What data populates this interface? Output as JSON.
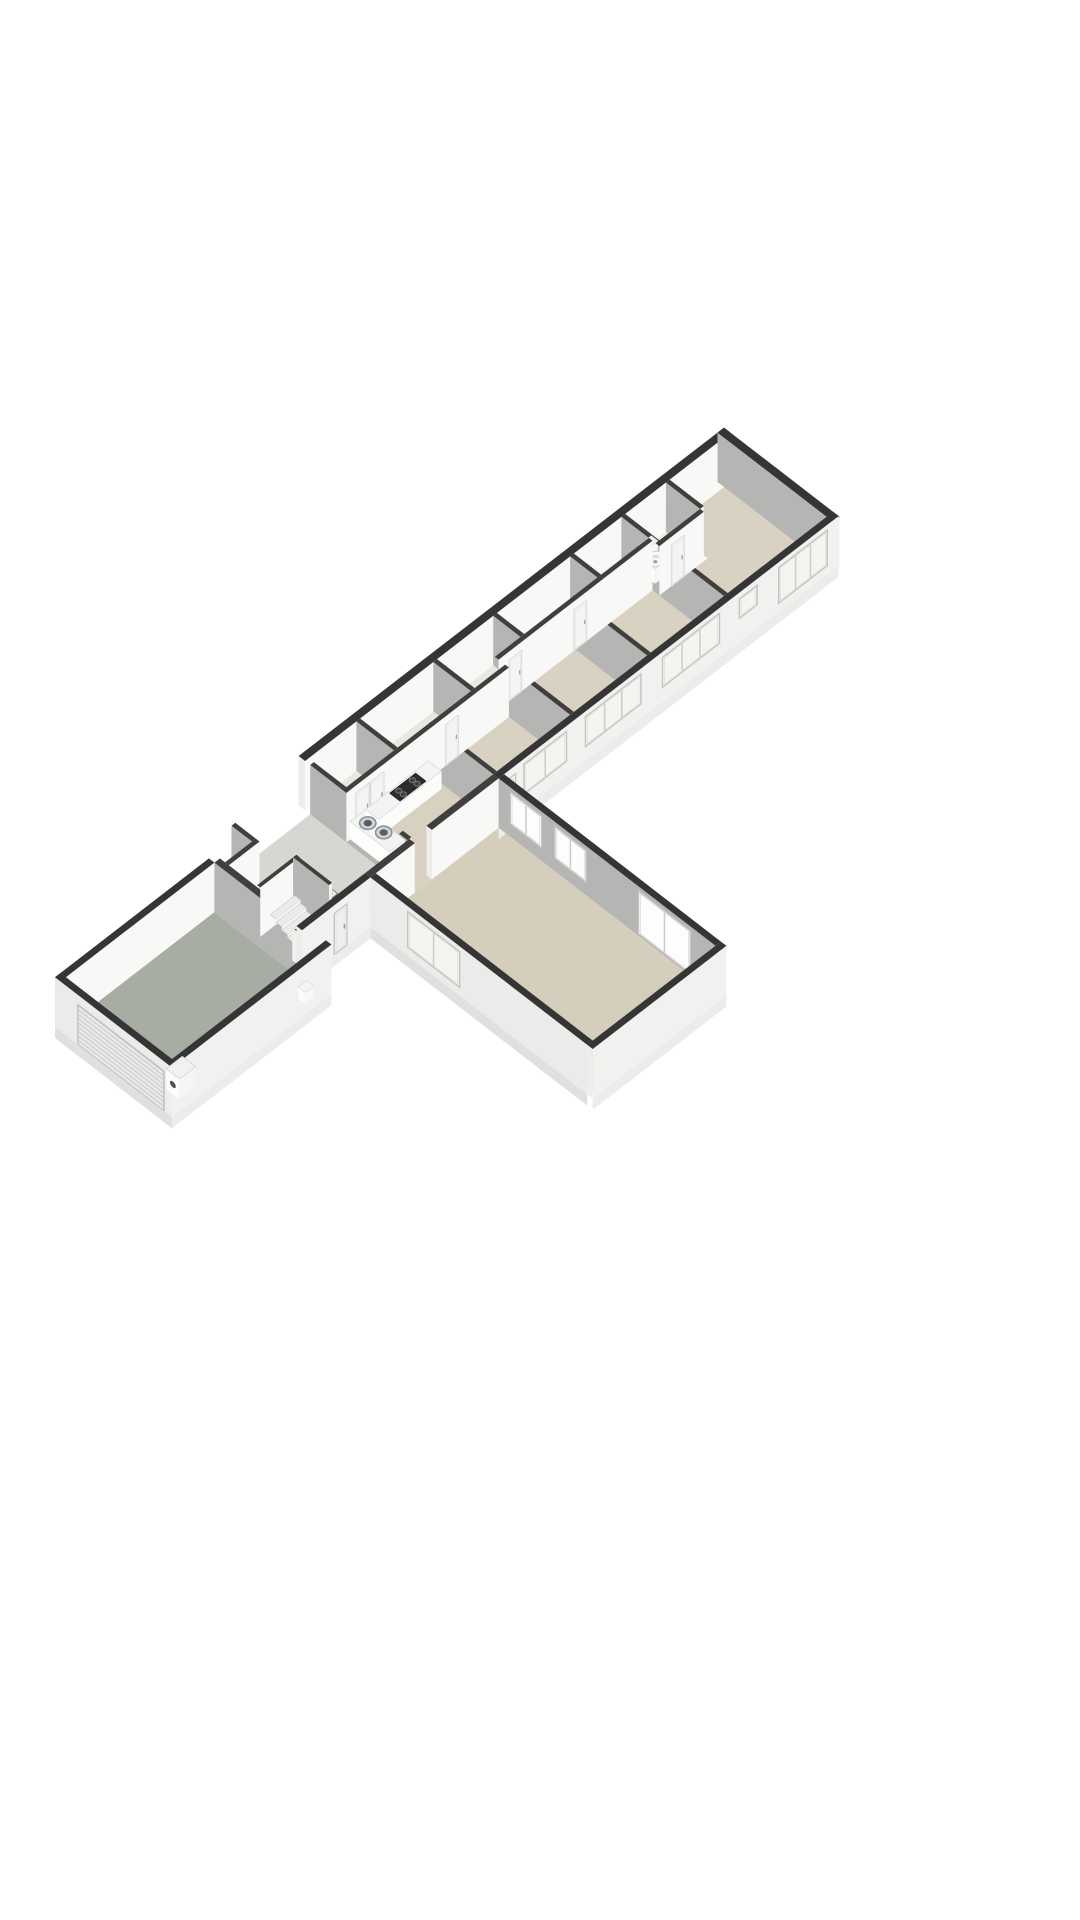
{
  "scene": {
    "type": "floorplan-3d-isometric",
    "background": "#ffffff",
    "projection": {
      "sx": 17.1,
      "sy": 13.2,
      "zs": 19,
      "ox": 40,
      "oy": 1015,
      "wall_height": 2.6,
      "base_depth": 0.6
    },
    "palette": {
      "top_ext": "#353535",
      "top_int": "#3f3f3e",
      "wall_in_white": "#f8f8f7",
      "wall_in_gray": "#b5b5b3",
      "wall_ext": "#f1f1ef",
      "wall_ext_v": "#ebebe9",
      "cap": "#ededec",
      "cap2": "#f3f3f2",
      "base_v": "#ececea",
      "base_u": "#e0e0de",
      "frame": "#ffffff",
      "frame_stroke": "#c4c4c3",
      "glass": "#f5f4f1",
      "glass_bright": "#fdfdfd",
      "reveal": "#c2c2c1",
      "door_fill": "#f7f7f6",
      "door_panel": "#efefee",
      "floor_beige": "#d9d1c2",
      "floor_hall": "#d7d6d2",
      "floor_garage": "#a8ada3",
      "floor_corridor": "#e8e7e3",
      "floor_bath": "#eae9e6",
      "floor_living": "#d6cebd",
      "steel_rim": "#83898d",
      "steel": "#ced3d6",
      "steel_dark": "#565c60",
      "cooktop": "#2c2c2c",
      "burner": "#3f3f3f",
      "burner_ring": "#787878"
    },
    "items": [
      {
        "t": "floor",
        "name": "garage-floor",
        "r": [
          0.32,
          1.2,
          9,
          7.4
        ],
        "c": "#a8ada3"
      },
      {
        "t": "floor",
        "name": "hall-floor",
        "r": [
          9.32,
          0.3,
          15.5,
          6
        ],
        "c": "#d7d6d2"
      },
      {
        "t": "floor",
        "name": "hall-closet-floor",
        "r": [
          9.32,
          0.3,
          10.9,
          1.5
        ],
        "c": "#e7e6e3"
      },
      {
        "t": "floor",
        "name": "corridor-floor",
        "r": [
          15.72,
          0,
          34,
          2.2
        ],
        "c": "#e8e7e3"
      },
      {
        "t": "floor",
        "name": "bathroom-floor",
        "r": [
          34.22,
          0,
          36.6,
          2.0
        ],
        "c": "#eae9e6"
      },
      {
        "t": "floor",
        "name": "kitchen-floor",
        "r": [
          15.72,
          2.42,
          20.5,
          6
        ],
        "c": "#d8d0c0"
      },
      {
        "t": "floor",
        "name": "kitchen-living-threshold",
        "r": [
          15.6,
          6,
          16.6,
          6.32
        ],
        "c": "#d8d0c0"
      },
      {
        "t": "floor",
        "name": "hall-doorway-threshold",
        "r": [
          15.5,
          4.7,
          15.72,
          5.5
        ],
        "c": "#d7d6d2"
      },
      {
        "t": "floor",
        "name": "bedroom-1-floor",
        "r": [
          20.72,
          2.42,
          25,
          6
        ],
        "c": "#d9d1c2"
      },
      {
        "t": "floor",
        "name": "bedroom-2-floor",
        "r": [
          25.22,
          1.82,
          29.5,
          6
        ],
        "c": "#d9d1c2"
      },
      {
        "t": "floor",
        "name": "bedroom-3-floor",
        "r": [
          29.72,
          1.82,
          34,
          6
        ],
        "c": "#d9d1c2"
      },
      {
        "t": "floor",
        "name": "bedroom-4-floor-main",
        "r": [
          34.22,
          2.22,
          40,
          6
        ],
        "c": "#d9d1c2"
      },
      {
        "t": "floor",
        "name": "bedroom-4-floor-upper",
        "r": [
          36.82,
          0,
          40,
          2.22
        ],
        "c": "#d9d1c2"
      },
      {
        "t": "floor",
        "name": "living-room-floor",
        "r": [
          13.32,
          6.32,
          20.5,
          19
        ],
        "c": "#d6cebd"
      },
      {
        "t": "sky",
        "name": "hall-floor-hatch",
        "r": [
          11.9,
          2.7,
          13.3,
          4.1
        ],
        "fill": "#fdfdfc",
        "stroke": "#8f8f8e",
        "inset": 0.14
      },
      {
        "t": "sky",
        "name": "corridor-hatch-1",
        "r": [
          17.0,
          0.5,
          17.9,
          1.4
        ],
        "fill": "#f2f1ee",
        "stroke": "#9b9b99",
        "inset": 0.1
      },
      {
        "t": "sky",
        "name": "corridor-hatch-2",
        "r": [
          21.5,
          0.5,
          22.4,
          1.4
        ],
        "fill": "#f2f1ee",
        "stroke": "#9b9b99",
        "inset": 0.1
      },
      {
        "t": "sky",
        "name": "corridor-hatch-3",
        "r": [
          27.0,
          0.5,
          27.9,
          1.4
        ],
        "fill": "#f2f1ee",
        "stroke": "#9b9b99",
        "inset": 0.1
      },
      {
        "t": "sky",
        "name": "corridor-hatch-4",
        "r": [
          31.4,
          0.5,
          32.3,
          1.4
        ],
        "fill": "#f2f1ee",
        "stroke": "#9b9b99",
        "inset": 0.1
      },
      {
        "t": "wall",
        "name": "exterior-wall-north",
        "dir": "u",
        "u": 15.5,
        "v": -0.38,
        "len": 24.88,
        "th": 0.38,
        "face": "white",
        "topc": "ext",
        "cap": true
      },
      {
        "t": "wall",
        "name": "exterior-wall-east-end",
        "dir": "v",
        "u": 40,
        "v": -0.38,
        "len": 6.76,
        "th": 0.38,
        "face": "gray",
        "topc": "ext",
        "cap": true
      },
      {
        "t": "wall",
        "name": "partition-bath-right",
        "dir": "v",
        "u": 36.6,
        "v": 0,
        "len": 2.0,
        "th": 0.22,
        "face": "gray"
      },
      {
        "t": "wall",
        "name": "partition-bath-left",
        "dir": "v",
        "u": 34,
        "v": 0,
        "len": 6,
        "th": 0.22,
        "face": "gray"
      },
      {
        "t": "wall",
        "name": "partition-closet-d",
        "dir": "v",
        "u": 31,
        "v": 0,
        "len": 1.6,
        "th": 0.22,
        "face": "gray"
      },
      {
        "t": "wall",
        "name": "partition-bedroom-3",
        "dir": "v",
        "u": 29.5,
        "v": 1.6,
        "len": 4.4,
        "th": 0.22,
        "face": "gray"
      },
      {
        "t": "wall",
        "name": "partition-closet-c",
        "dir": "v",
        "u": 26.5,
        "v": 0,
        "len": 1.6,
        "th": 0.22,
        "face": "gray"
      },
      {
        "t": "wall",
        "name": "partition-bedroom-2",
        "dir": "v",
        "u": 25,
        "v": 2.2,
        "len": 3.8,
        "th": 0.22,
        "face": "gray"
      },
      {
        "t": "wall",
        "name": "partition-closet-b",
        "dir": "v",
        "u": 23,
        "v": 0,
        "len": 2.2,
        "th": 0.22,
        "face": "gray"
      },
      {
        "t": "wall",
        "name": "partition-bedroom-1",
        "dir": "v",
        "u": 20.5,
        "v": 2.2,
        "len": 3.8,
        "th": 0.22,
        "face": "gray"
      },
      {
        "t": "wall",
        "name": "partition-closet-a",
        "dir": "v",
        "u": 18.5,
        "v": 0,
        "len": 2.2,
        "th": 0.22,
        "face": "gray"
      },
      {
        "t": "wall",
        "name": "hall-east-wall-a",
        "dir": "v",
        "u": 15.5,
        "v": 0.3,
        "len": 4.4,
        "th": 0.22,
        "face": "gray"
      },
      {
        "t": "wall",
        "name": "hall-east-wall-b",
        "dir": "v",
        "u": 15.5,
        "v": 5.5,
        "len": 0.5,
        "th": 0.22,
        "face": "gray"
      },
      {
        "t": "box",
        "name": "toilet-tank",
        "r": [
          34.7,
          0.3,
          35.45,
          0.68
        ],
        "z2": 0.8,
        "top": "#f3f3f2",
        "su": "#fbfbfa",
        "sv": "#f6f6f5",
        "stroke": "#d8d8d6"
      },
      {
        "t": "disc",
        "name": "toilet-bowl",
        "c": [
          35.05,
          1.02
        ],
        "rad": 0.35,
        "z": 0.42,
        "fill": "#fcfcfb",
        "stroke": "#cfcfce",
        "sw": 1,
        "inner": {
          "rad": 0.19,
          "fill": "#e9ebeb"
        }
      },
      {
        "t": "box",
        "name": "bathroom-sink-pedestal",
        "r": [
          34.32,
          1.1,
          34.85,
          1.65
        ],
        "z2": 0.78,
        "top": "#f3f3f2",
        "su": "#fbfbfa",
        "sv": "#f6f6f5",
        "stroke": "#d8d8d6"
      },
      {
        "t": "disc",
        "name": "bathroom-sink-basin",
        "c": [
          34.6,
          1.38
        ],
        "rad": 0.27,
        "z": 0.78,
        "fill": "#f4f5f5",
        "stroke": "#c9c9c8",
        "sw": 1,
        "inner": {
          "rad": 0.09,
          "fill": "#9fa3a5"
        }
      },
      {
        "t": "wall",
        "name": "corridor-wall-bedrooms-23",
        "dir": "u",
        "u": 25,
        "v": 1.6,
        "len": 9,
        "th": 0.22,
        "face": "white",
        "panels": [
          {
            "a": 0.6,
            "b": 1.35,
            "h": 2.15
          },
          {
            "a": 4.4,
            "b": 5.15,
            "h": 2.15
          }
        ]
      },
      {
        "t": "wall",
        "name": "bathroom-front-wall",
        "dir": "u",
        "u": 34,
        "v": 2.0,
        "len": 2.6,
        "th": 0.22,
        "face": "white",
        "panels": [
          {
            "a": 0.7,
            "b": 1.45,
            "h": 2.15
          }
        ]
      },
      {
        "t": "wall",
        "name": "corridor-wall-kitchen",
        "dir": "u",
        "u": 15.5,
        "v": 2.2,
        "len": 9.5,
        "th": 0.22,
        "face": "white",
        "panels": [
          {
            "a": 0.55,
            "b": 1.35,
            "h": 2.2
          },
          {
            "a": 1.4,
            "b": 2.2,
            "h": 2.2
          },
          {
            "a": 5.8,
            "b": 6.55,
            "h": 2.15
          }
        ]
      },
      {
        "t": "wall",
        "name": "hall-closet-side-wall",
        "dir": "v",
        "u": 10.9,
        "v": 0.3,
        "len": 1.2,
        "th": 0.22,
        "face": "gray"
      },
      {
        "t": "wall",
        "name": "hall-closet-front-wall",
        "dir": "u",
        "u": 9.32,
        "v": 1.5,
        "len": 1.8,
        "th": 0.22,
        "face": "white"
      },
      {
        "t": "wall",
        "name": "garage-north-wall",
        "dir": "u",
        "u": 0,
        "v": 0.88,
        "len": 9,
        "th": 0.32,
        "face": "white",
        "topc": "ext"
      },
      {
        "t": "wall",
        "name": "garage-hall-wall",
        "dir": "v",
        "u": 9,
        "v": 1.2,
        "len": 6.2,
        "th": 0.32,
        "face": "gray",
        "panels": [
          {
            "a": 5.1,
            "b": 5.8,
            "h": 2.1
          }
        ]
      },
      {
        "t": "wall",
        "name": "stair-back-wall",
        "dir": "u",
        "u": 9.4,
        "v": 3.3,
        "len": 2.3,
        "th": 0.18,
        "face": "white"
      },
      {
        "t": "wall",
        "name": "stair-side-wall",
        "dir": "v",
        "u": 11.5,
        "v": 3.3,
        "len": 2.1,
        "th": 0.18,
        "face": "gray"
      },
      {
        "t": "stairs",
        "name": "staircase",
        "u1": 9.9,
        "u2": 11.34,
        "v0": 3.56,
        "dv": 0.34,
        "n": 5,
        "ztop": 0.88,
        "dz": 0.175
      },
      {
        "t": "box",
        "name": "hall-bookshelf",
        "r": [
          9.45,
          5.3,
          10.15,
          5.92
        ],
        "z2": 1.6,
        "top": "#f6f6f5",
        "su": "#f0f0ef",
        "sv": "#f3f3f2",
        "stroke": "#d5d5d3",
        "stripes": [
          [
            "#7c2b28",
            0.06
          ],
          [
            "#27241f",
            0.07
          ],
          [
            "#8d4a38",
            0.06
          ],
          [
            "#33302b",
            0.07
          ],
          [
            "#6e2320",
            0.06
          ],
          [
            "#3c3a36",
            0.07
          ]
        ]
      },
      {
        "t": "box",
        "name": "kitchen-counter-left",
        "r": [
          15.72,
          2.42,
          16.62,
          4.72
        ],
        "z2": 0.95,
        "top": "#f3f3f1",
        "su": "#fdfdfc",
        "sv": "#fbfbfa",
        "stroke": "#d6d6d4"
      },
      {
        "t": "box",
        "name": "kitchen-counter-back",
        "r": [
          16.62,
          2.42,
          20.3,
          3.18
        ],
        "z2": 0.95,
        "top": "#f3f3f1",
        "su": "#fdfdfc",
        "sv": "#fbfbfa",
        "stroke": "#d6d6d4"
      },
      {
        "t": "disc",
        "name": "kitchen-sink-bowl-1",
        "c": [
          16.17,
          3.0
        ],
        "rad": 0.34,
        "z": 0.95,
        "fill": "#ced3d6",
        "stroke": "#83898d",
        "sw": 1.4,
        "inner": {
          "rad": 0.17,
          "fill": "#565c60"
        }
      },
      {
        "t": "disc",
        "name": "kitchen-sink-bowl-2",
        "c": [
          16.28,
          3.82
        ],
        "rad": 0.34,
        "z": 0.95,
        "fill": "#ced3d6",
        "stroke": "#83898d",
        "sw": 1.4,
        "inner": {
          "rad": 0.17,
          "fill": "#565c60"
        }
      },
      {
        "t": "hob",
        "name": "kitchen-cooktop",
        "r": [
          17.95,
          2.52,
          19.45,
          3.1
        ],
        "z": 0.952,
        "fill": "#2c2c2c",
        "stroke": "#1f1f1f",
        "burners": [
          [
            18.3,
            2.68
          ],
          [
            18.3,
            2.95
          ],
          [
            19.1,
            2.68
          ],
          [
            19.1,
            2.95
          ]
        ],
        "br": 0.13
      },
      {
        "t": "wall",
        "name": "exterior-wall-south-wing",
        "dir": "u",
        "u": 20.5,
        "v": 6,
        "len": 19.88,
        "th": 0.32,
        "face": "ext",
        "topc": "ext",
        "base": true,
        "cap": true,
        "windows": [
          {
            "type": "door",
            "a": 0.3,
            "b": 0.98,
            "z1": 0,
            "z2": 2.15
          },
          {
            "a": 1.5,
            "b": 3.95,
            "z1": 0.75,
            "z2": 2.3,
            "m": 2
          },
          {
            "a": 5.1,
            "b": 8.3,
            "z1": 0.75,
            "z2": 2.3,
            "m": 3
          },
          {
            "a": 9.6,
            "b": 12.9,
            "z1": 0.75,
            "z2": 2.3,
            "m": 3
          },
          {
            "a": 14.1,
            "b": 15.1,
            "z1": 1.25,
            "z2": 2.25,
            "m": 1
          },
          {
            "a": 16.4,
            "b": 19.2,
            "z1": 0.45,
            "z2": 2.3,
            "m": 3
          }
        ]
      },
      {
        "t": "wall",
        "name": "living-north-wall-a",
        "dir": "u",
        "u": 13,
        "v": 6,
        "len": 2.6,
        "th": 0.32,
        "face": "white",
        "cap": true
      },
      {
        "t": "wall",
        "name": "living-north-wall-b",
        "dir": "u",
        "u": 16.6,
        "v": 6,
        "len": 3.9,
        "th": 0.32,
        "face": "white",
        "cap": true
      },
      {
        "t": "wall",
        "name": "hall-front-wall",
        "dir": "u",
        "u": 9,
        "v": 6,
        "len": 4,
        "th": 0.32,
        "face": "ext",
        "topc": "ext",
        "base": true,
        "cap": true,
        "windows": [
          {
            "type": "door",
            "a": 1.9,
            "b": 2.62,
            "z1": 0,
            "z2": 2.15
          }
        ]
      },
      {
        "t": "wall",
        "name": "garage-end-wall",
        "dir": "v",
        "u": 0,
        "v": 0.88,
        "len": 6.84,
        "th": 0.32,
        "face": "extv",
        "topc": "ext",
        "base": true,
        "cap": true,
        "windows": [
          {
            "type": "garage",
            "a": 1.35,
            "b": 6.35,
            "z1": 0,
            "z2": 2.05,
            "slats": 8
          }
        ]
      },
      {
        "t": "wall",
        "name": "garage-south-wall",
        "dir": "u",
        "u": 0,
        "v": 7.4,
        "len": 9.32,
        "th": 0.32,
        "face": "ext",
        "topc": "ext",
        "base": true,
        "cap": true
      },
      {
        "t": "box",
        "name": "garage-boiler",
        "r": [
          0.88,
          6.5,
          1.82,
          7.28
        ],
        "z2": 1.08,
        "top": "#f1f1f0",
        "su": "#fcfcfb",
        "sv": "#f5f5f4",
        "stroke": "#d0d0cf",
        "decal": {
          "v": 6.89,
          "z": 0.52,
          "rad": 0.17,
          "fill": "#4d4d4c"
        }
      },
      {
        "t": "box",
        "name": "garage-utility-sink",
        "r": [
          8.18,
          6.92,
          8.68,
          7.34
        ],
        "z2": 0.6,
        "top": "#f4f4f3",
        "su": "#fcfcfb",
        "sv": "#f7f7f6",
        "stroke": "#d8d8d6"
      },
      {
        "t": "wall",
        "name": "living-east-wall",
        "dir": "v",
        "u": 20.5,
        "v": 6.32,
        "len": 12.68,
        "th": 0.32,
        "face": "gray",
        "topc": "ext",
        "windows": [
          {
            "a": 0.7,
            "b": 2.5,
            "z1": 0.7,
            "z2": 2.35,
            "m": 2
          },
          {
            "a": 3.3,
            "b": 5.1,
            "z1": 0.7,
            "z2": 2.35,
            "m": 2
          },
          {
            "a": 8.2,
            "b": 11.2,
            "z1": 0.12,
            "z2": 2.35,
            "m": 2
          }
        ]
      },
      {
        "t": "wall",
        "name": "living-west-wall",
        "dir": "v",
        "u": 13,
        "v": 6.32,
        "len": 12.68,
        "th": 0.32,
        "face": "extv",
        "topc": "ext",
        "base": true,
        "cap": true,
        "windows": [
          {
            "a": 2.2,
            "b": 5.2,
            "z1": 0.45,
            "z2": 2.3,
            "m": 2
          }
        ]
      },
      {
        "t": "wall",
        "name": "living-south-wall",
        "dir": "u",
        "u": 13,
        "v": 19,
        "len": 7.82,
        "th": 0.32,
        "face": "ext",
        "topc": "ext",
        "base": true,
        "cap": true
      }
    ]
  }
}
